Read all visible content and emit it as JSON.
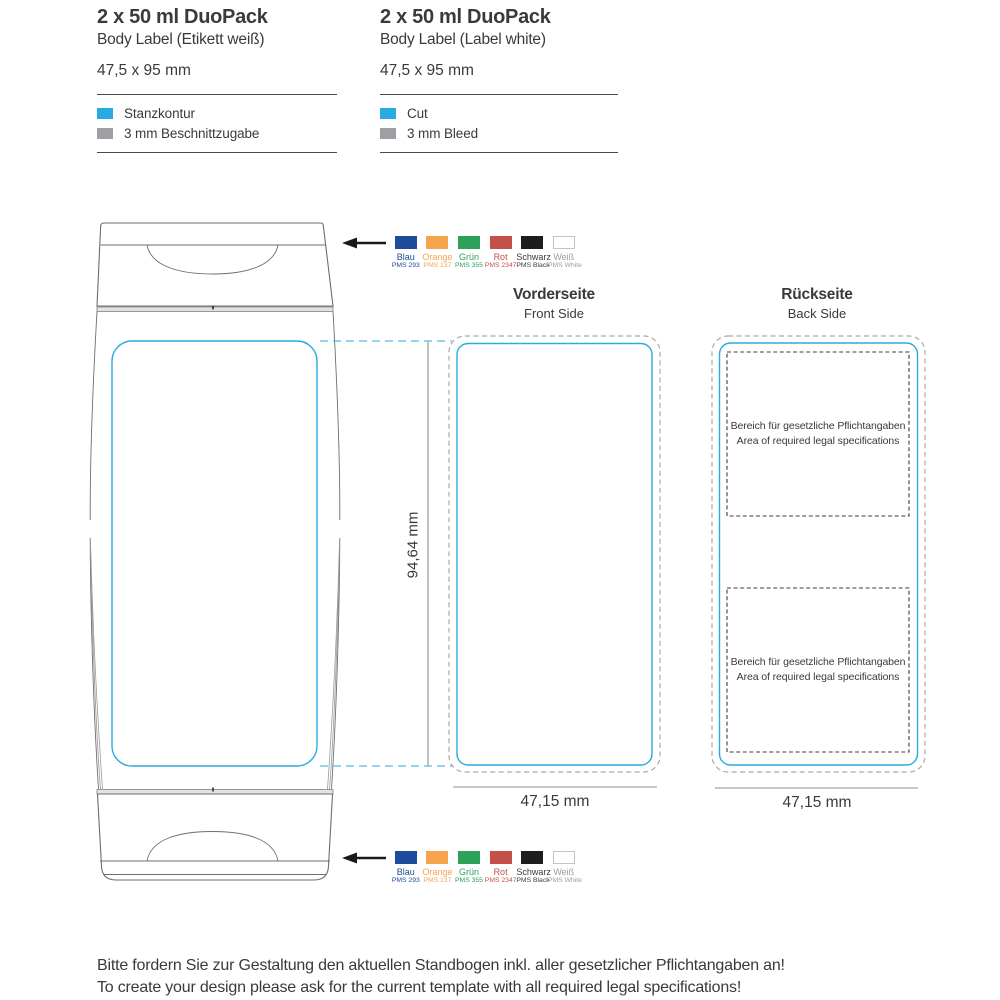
{
  "colors": {
    "cut": "#29abe2",
    "bleed": "#9d9fa2",
    "bleed_outline": "#a7a9ac",
    "dimension_line": "#b1b3b6",
    "drawing_outline": "#6d6e71",
    "legal_box": "#3c3c3b",
    "text": "#3a3a3a",
    "arrow": "#1a1a1a"
  },
  "spec_blocks": [
    {
      "title": "2 x 50 ml DuoPack",
      "subtitle": "Body Label (Etikett weiß)",
      "dimensions": "47,5 x 95 mm",
      "legend": [
        {
          "label": "Stanzkontur",
          "color": "#29abe2"
        },
        {
          "label": "3 mm Beschnittzugabe",
          "color": "#9d9fa2"
        }
      ]
    },
    {
      "title": "2 x 50 ml DuoPack",
      "subtitle": "Body Label (Label white)",
      "dimensions": "47,5 x 95 mm",
      "legend": [
        {
          "label": "Cut",
          "color": "#29abe2"
        },
        {
          "label": "3 mm Bleed",
          "color": "#9d9fa2"
        }
      ]
    }
  ],
  "swatches": [
    {
      "name": "Blau",
      "pms": "PMS 293",
      "color": "#1e4b9b"
    },
    {
      "name": "Orange",
      "pms": "PMS 137",
      "color": "#f6a44e"
    },
    {
      "name": "Grün",
      "pms": "PMS 355",
      "color": "#2da05a"
    },
    {
      "name": "Rot",
      "pms": "PMS 2347",
      "color": "#c4504b"
    },
    {
      "name": "Schwarz",
      "pms": "PMS Black",
      "color": "#1d1d1b",
      "label_color": "#3c3c3b"
    },
    {
      "name": "Weiß",
      "pms": "PMS White",
      "color": "#ffffff",
      "label_color": "#9d9d9c"
    }
  ],
  "panels": {
    "front": {
      "title": "Vorderseite",
      "subtitle": "Front Side",
      "width_label": "47,15 mm",
      "height_label": "94,64 mm"
    },
    "back": {
      "title": "Rückseite",
      "subtitle": "Back Side",
      "width_label": "47,15 mm",
      "legal_area": {
        "line1": "Bereich für gesetzliche Pflichtangaben",
        "line2": "Area of required legal specifications"
      }
    }
  },
  "footer": {
    "line1": "Bitte fordern Sie zur Gestaltung den aktuellen Standbogen inkl. aller gesetzlicher Pflichtangaben an!",
    "line2": "To create your design please ask for the current template with all required legal specifications!"
  }
}
